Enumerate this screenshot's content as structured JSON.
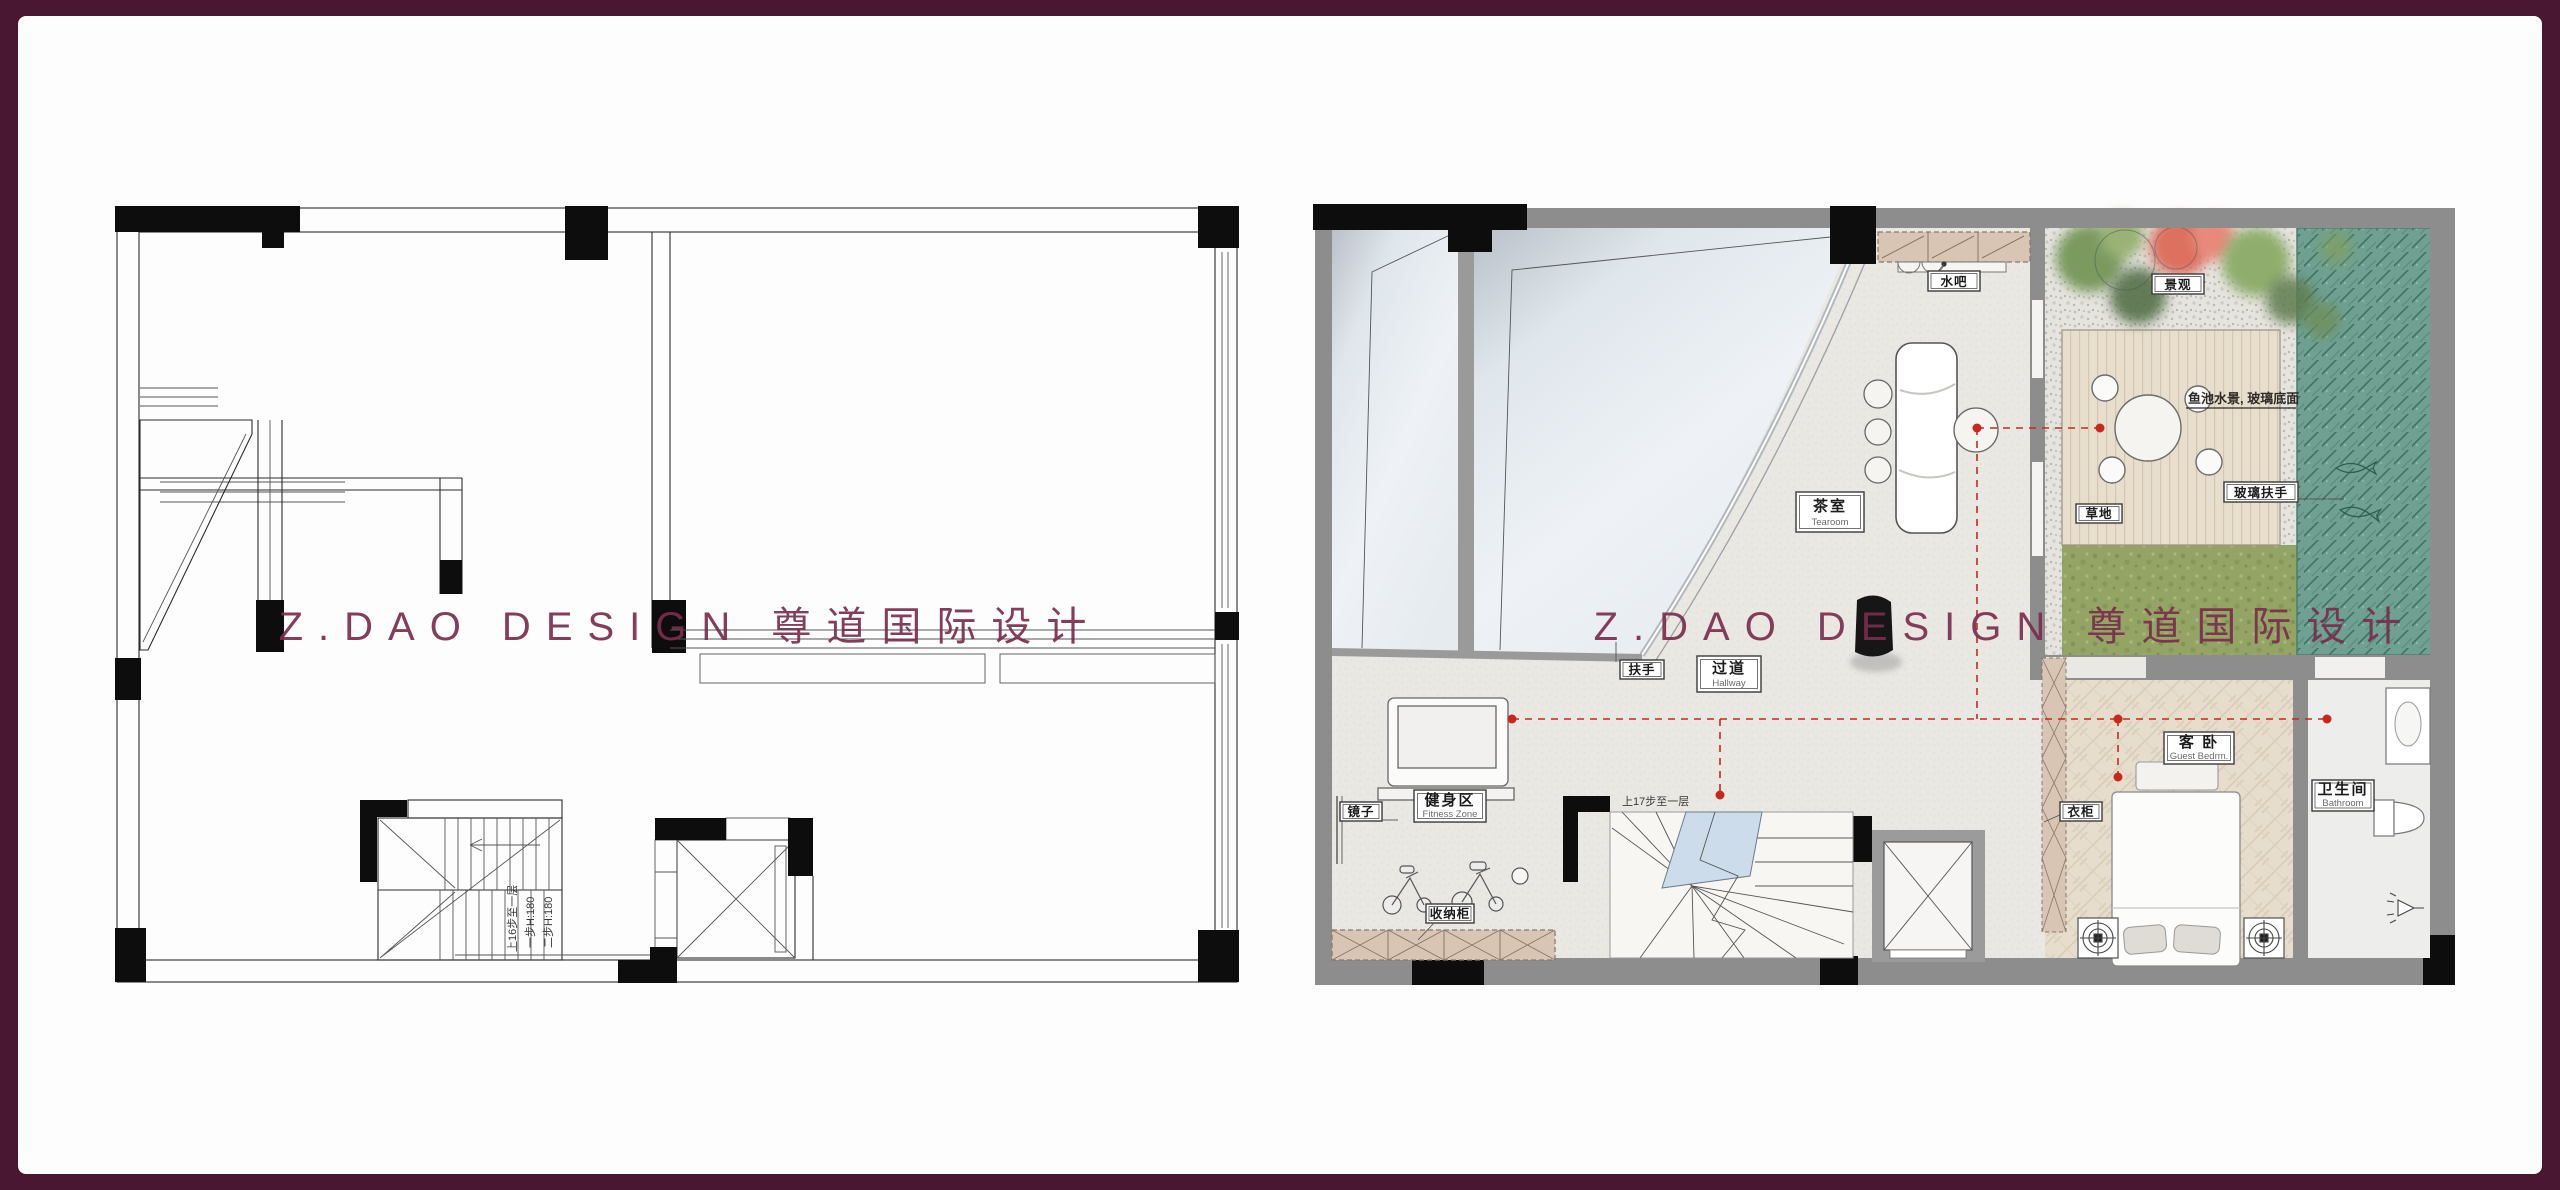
{
  "frame": {
    "background": "#4a1732",
    "panel": "#fdfdfd"
  },
  "watermark": {
    "text": "Z.DAO DESIGN 尊道国际设计",
    "color": "#7a2d4d"
  },
  "left_plan": {
    "title": "structural-base-plan",
    "stair_notes": [
      "上16步至一层",
      "一步H:180",
      "二步H:180"
    ]
  },
  "right_plan": {
    "title": "furnished-layout-plan",
    "labels": {
      "water_bar": "水吧",
      "landscape": "景观",
      "tea_room_zh": "茶室",
      "tea_room_en": "Tearoom",
      "fish_pond_note": "鱼池水景, 玻璃底面",
      "glass_rail": "玻璃扶手",
      "grass": "草地",
      "handrail": "扶手",
      "hallway_zh": "过道",
      "hallway_en": "Hallway",
      "guest_bedroom_zh": "客 卧",
      "guest_bedroom_en": "Guest Bedrm.",
      "mirror": "镜子",
      "fitness_zh": "健身区",
      "fitness_en": "Fitness Zone",
      "stairs_note": "上17步至一层",
      "storage": "收纳柜",
      "wardrobe": "衣柜",
      "bathroom_zh": "卫生间",
      "bathroom_en": "Bathroom"
    },
    "colors": {
      "water": "#6fa092",
      "grass": "#93a465",
      "deck": "#e7ddcb",
      "wall": "#8d8d8d",
      "annotation": "#c6281c",
      "cabinet": "#d9c5b3",
      "landing": "#cddcea",
      "floor": "#eae8e4"
    }
  }
}
